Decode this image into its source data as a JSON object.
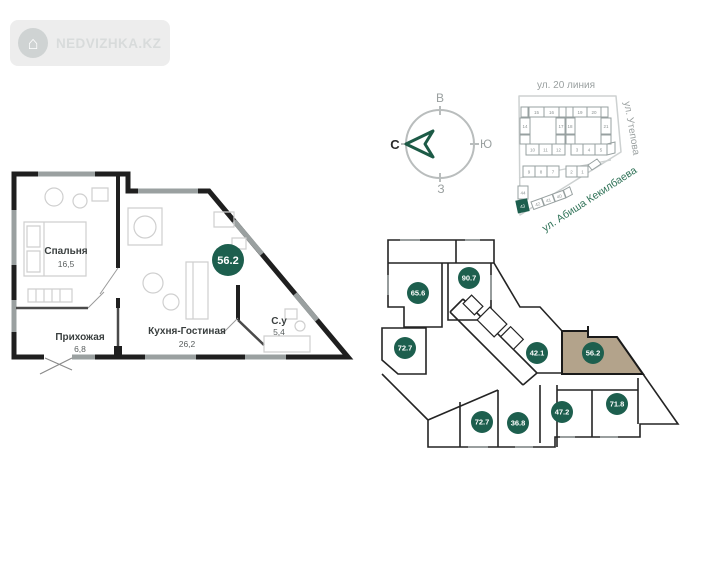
{
  "watermark": {
    "brand": "NEDVIZHKA.KZ"
  },
  "apartment_plan": {
    "total_area": "56.2",
    "rooms": [
      {
        "name": "Спальня",
        "area": "16,5"
      },
      {
        "name": "Прихожая",
        "area": "6,8"
      },
      {
        "name": "Кухня-Гостиная",
        "area": "26,2"
      },
      {
        "name": "С.у",
        "area": "5,4"
      }
    ]
  },
  "compass": {
    "north": "С",
    "south": "Ю",
    "east": "В",
    "west": "З"
  },
  "site_map": {
    "streets": {
      "top": "ул. 20 линия",
      "right": "ул. Утепова",
      "diagonal": "ул. Абиша Кекилбаева"
    },
    "blocks": [
      "15",
      "16",
      "14",
      "17",
      "19",
      "20",
      "18",
      "21",
      "10",
      "11",
      "12",
      "3",
      "4",
      "5",
      "9",
      "8",
      "7",
      "2",
      "1",
      "44",
      "43",
      "42",
      "41",
      "40"
    ],
    "highlighted_block": "43"
  },
  "floor_plan": {
    "units": [
      "65.6",
      "90.7",
      "72.7",
      "42.1",
      "56.2",
      "72.7",
      "36.8",
      "47.2",
      "71.8"
    ],
    "highlighted_unit": "56.2"
  },
  "colors": {
    "accent_green": "#1d5f4e",
    "highlight_tan": "#b3a38b"
  }
}
